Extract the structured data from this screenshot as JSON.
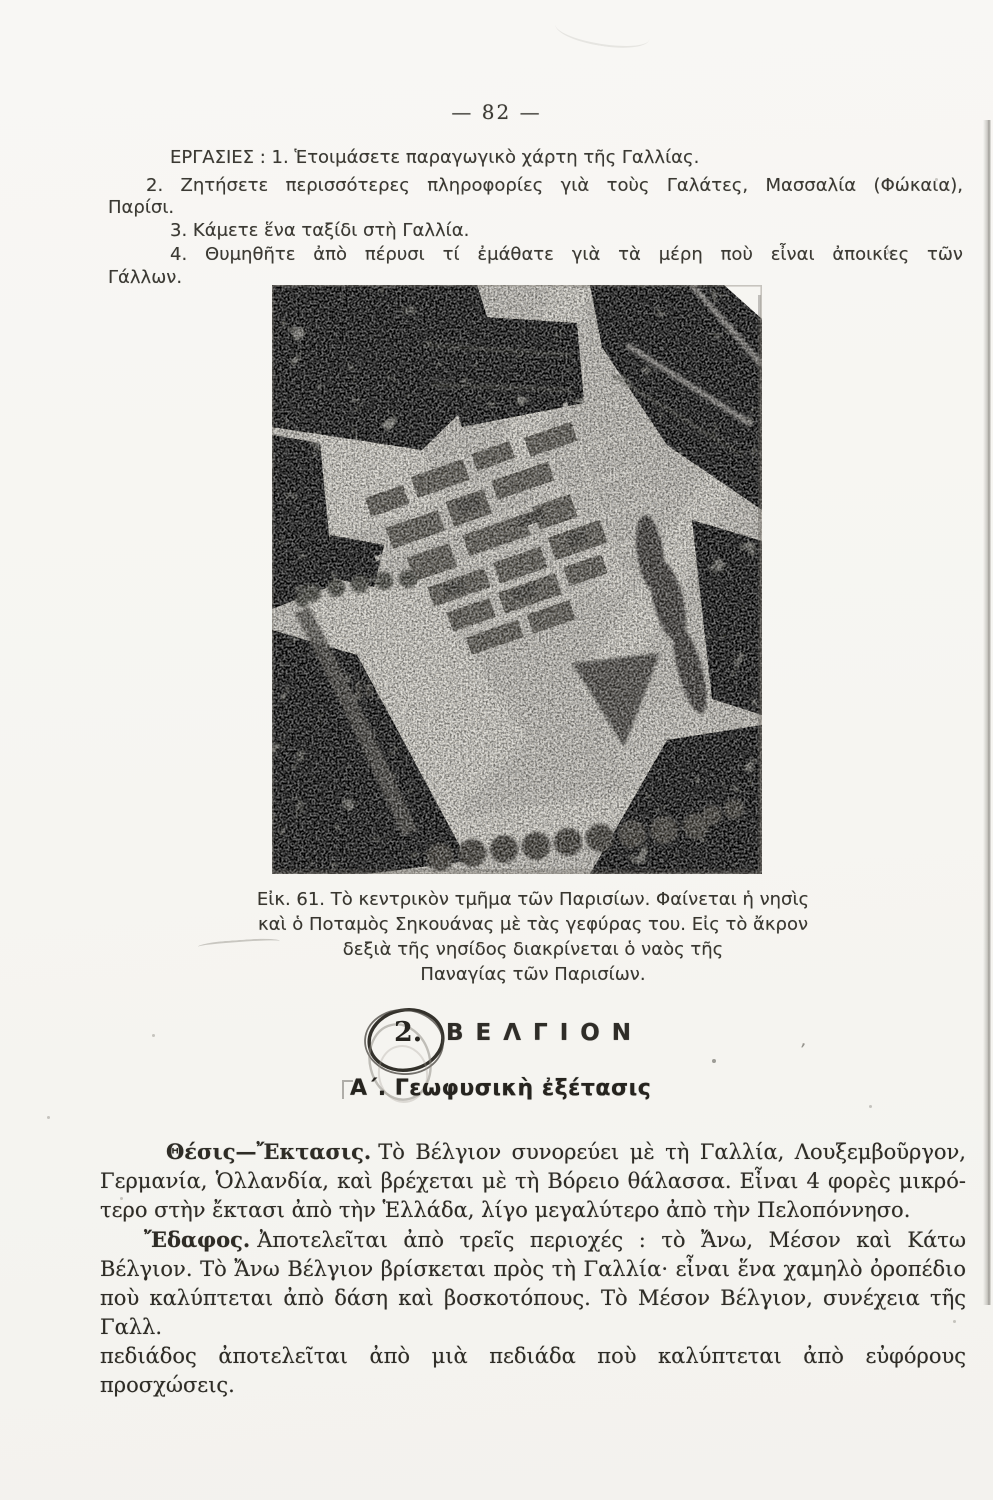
{
  "page": {
    "number": "— 82 —"
  },
  "exercises": {
    "lines": [
      "ΕΡΓΑΣΙΕΣ : 1. Ἑτοιμάσετε παραγωγικὸ χάρτη τῆς Γαλλίας.",
      "2. Ζητήσετε περισσότερες πληροφορίες γιὰ τοὺς Γαλάτες, Μασσαλία (Φώκαια),",
      "Παρίσι.",
      "3. Κάμετε ἕνα ταξίδι στὴ Γαλλία.",
      "4. Θυμηθῆτε ἀπὸ πέρυσι τί ἐμάθατε γιὰ τὰ μέρη ποὺ εἶναι ἀποικίες τῶν",
      "Γάλλων."
    ]
  },
  "figure": {
    "caption_lines": [
      "Εἰκ. 61. Τὸ κεντρικὸν τμῆμα τῶν Παρισίων. Φαίνεται ἡ νησὶς",
      "καὶ ὁ Ποταμὸς Σηκουάνας μὲ τὰς γεφύρας του. Εἰς τὸ ἄκρον",
      "δεξιὰ τῆς νησίδος διακρίνεται ὁ ναὸς τῆς",
      "Παναγίας τῶν Παρισίων."
    ]
  },
  "section": {
    "number": "2.",
    "title": "ΒΕΛΓΙΟΝ",
    "subtitle": "Α΄. Γεωφυσικὴ ἐξέτασις"
  },
  "body": {
    "p1": {
      "lead": "Θέσις—Ἔκτασις.",
      "l1": "Τὸ Βέλγιον συνορεύει μὲ τὴ Γαλλία, Λουξεμβοῦργον,",
      "l2": "Γερμανία, Ὁλλανδία, καὶ βρέχεται μὲ τὴ Βόρειο θάλασσα. Εἶναι 4 φορὲς μικρό-",
      "l3": "τερο στὴν ἔκτασι ἀπὸ τὴν Ἑλλάδα, λίγο μεγαλύτερο ἀπὸ τὴν Πελοπόννησο."
    },
    "p2": {
      "lead": "Ἔδαφος.",
      "l1": "Ἀποτελεῖται ἀπὸ τρεῖς περιοχές : τὸ Ἄνω, Μέσον καὶ Κάτω",
      "l2": "Βέλγιον. Τὸ Ἄνω Βέλγιον βρίσκεται πρὸς τὴ Γαλλία· εἶναι ἕνα χαμηλὸ ὀροπέδιο",
      "l3": "ποὺ καλύπτεται ἀπὸ δάση καὶ βοσκοτόπους. Τὸ Μέσον Βέλγιον, συνέχεια τῆς Γαλλ.",
      "l4": "πεδιάδος ἀποτελεῖται ἀπὸ μιὰ πεδιάδα ποὺ καλύπτεται ἀπὸ εὐφόρους προσχώσεις."
    }
  },
  "colors": {
    "paper": "#f7f6f2",
    "ink": "#2e2c26",
    "photo_base": "#c7c4bc",
    "photo_dark": "#3e3b35"
  }
}
